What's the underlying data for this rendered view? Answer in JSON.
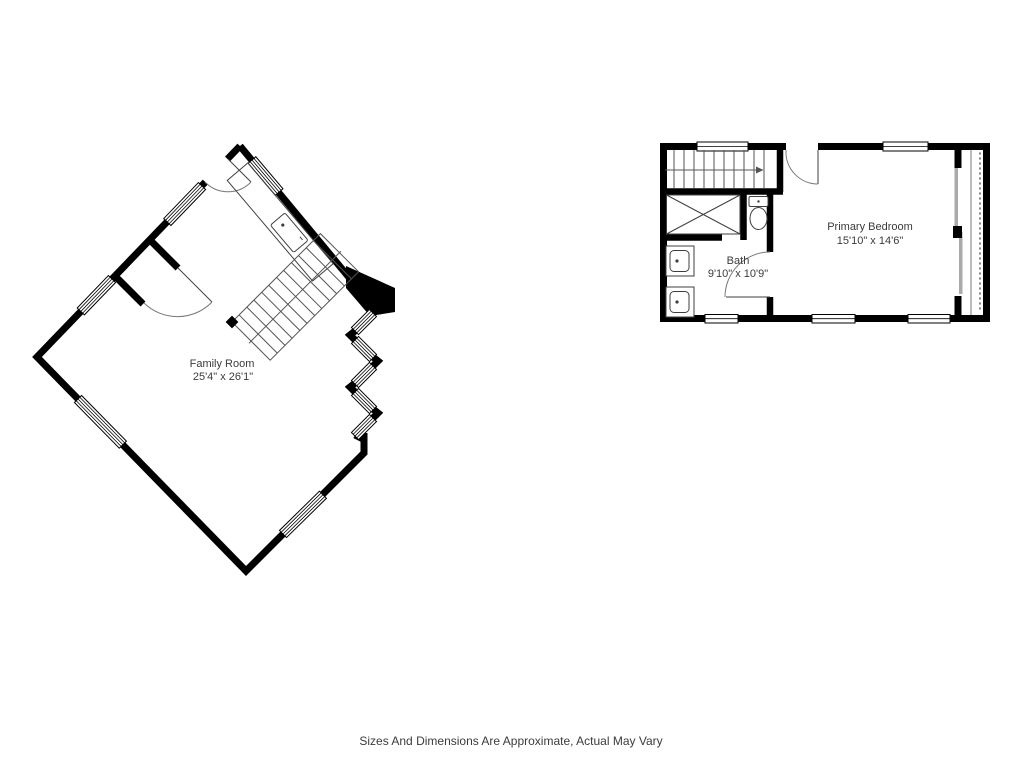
{
  "page": {
    "background": "#ffffff",
    "disclaimer": "Sizes And Dimensions Are Approximate, Actual May Vary"
  },
  "plans": {
    "main_level": {
      "rooms": [
        {
          "name": "Family Room",
          "dimensions": "25'4\" x 26'1\""
        }
      ]
    },
    "upper_level": {
      "rooms": [
        {
          "name": "Primary Bedroom",
          "dimensions": "15'10\" x 14'6\""
        },
        {
          "name": "Bath",
          "dimensions": "9'10\" x 10'9\""
        }
      ]
    }
  },
  "colors": {
    "wall": "#000000",
    "fixture_line": "#3f3f3f",
    "stair_line": "#555555",
    "slider_gray": "#aaaaaa",
    "text": "#3b3b3b"
  }
}
